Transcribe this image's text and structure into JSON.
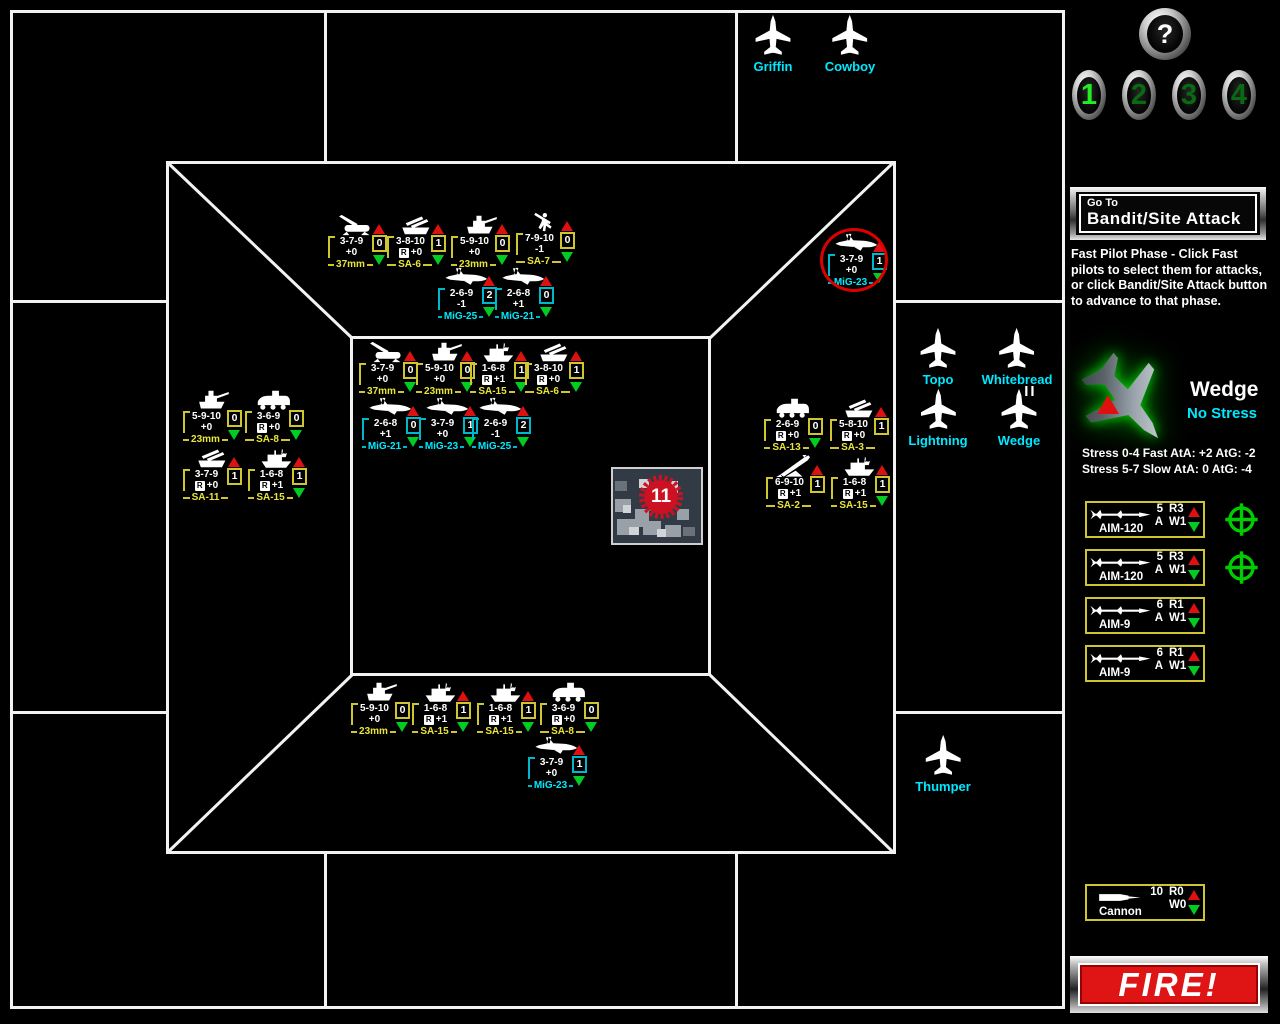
{
  "board": {
    "target": {
      "label": "11"
    },
    "counters": [
      {
        "type": "37mm",
        "icon": "aaa-gun-icon",
        "stats": "3-7-9",
        "mod": "+0",
        "radar": false,
        "value": "0",
        "up": true,
        "down": true,
        "color": "yellow",
        "circled": false,
        "x": 328,
        "y": 214
      },
      {
        "type": "SA-6",
        "icon": "samtrack-icon",
        "stats": "3-8-10",
        "mod": "+0",
        "radar": true,
        "value": "1",
        "up": true,
        "down": true,
        "color": "yellow",
        "circled": false,
        "x": 387,
        "y": 214
      },
      {
        "type": "23mm",
        "icon": "spaag-icon",
        "stats": "5-9-10",
        "mod": "+0",
        "radar": false,
        "value": "0",
        "up": true,
        "down": true,
        "color": "yellow",
        "circled": false,
        "x": 451,
        "y": 214
      },
      {
        "type": "SA-7",
        "icon": "manpad-icon",
        "stats": "7-9-10",
        "mod": "-1",
        "radar": false,
        "value": "0",
        "up": true,
        "down": true,
        "color": "yellow",
        "circled": false,
        "x": 516,
        "y": 211
      },
      {
        "type": "MiG-25",
        "icon": "mig-icon",
        "stats": "2-6-9",
        "mod": "-1",
        "radar": false,
        "value": "2",
        "up": true,
        "down": true,
        "color": "cyan",
        "circled": false,
        "x": 438,
        "y": 266
      },
      {
        "type": "MiG-21",
        "icon": "mig-icon",
        "stats": "2-6-8",
        "mod": "+1",
        "radar": false,
        "value": "0",
        "up": true,
        "down": true,
        "color": "cyan",
        "circled": false,
        "x": 495,
        "y": 266
      },
      {
        "type": "MiG-23",
        "icon": "mig-icon",
        "stats": "3-7-9",
        "mod": "+0",
        "radar": false,
        "value": "1",
        "up": true,
        "down": true,
        "color": "cyan",
        "circled": true,
        "x": 828,
        "y": 232
      },
      {
        "type": "37mm",
        "icon": "aaa-gun-icon",
        "stats": "3-7-9",
        "mod": "+0",
        "radar": false,
        "value": "0",
        "up": true,
        "down": true,
        "color": "yellow",
        "circled": false,
        "x": 359,
        "y": 341
      },
      {
        "type": "23mm",
        "icon": "spaag-icon",
        "stats": "5-9-10",
        "mod": "+0",
        "radar": false,
        "value": "0",
        "up": true,
        "down": true,
        "color": "yellow",
        "circled": false,
        "x": 416,
        "y": 341
      },
      {
        "type": "SA-15",
        "icon": "launcher-icon",
        "stats": "1-6-8",
        "mod": "+1",
        "radar": true,
        "value": "1",
        "up": true,
        "down": true,
        "color": "yellow",
        "circled": false,
        "x": 470,
        "y": 341
      },
      {
        "type": "SA-6",
        "icon": "samtrack-icon",
        "stats": "3-8-10",
        "mod": "+0",
        "radar": true,
        "value": "1",
        "up": true,
        "down": true,
        "color": "yellow",
        "circled": false,
        "x": 525,
        "y": 341
      },
      {
        "type": "MiG-21",
        "icon": "mig-icon",
        "stats": "2-6-8",
        "mod": "+1",
        "radar": false,
        "value": "0",
        "up": true,
        "down": true,
        "color": "cyan",
        "circled": false,
        "x": 362,
        "y": 396
      },
      {
        "type": "MiG-23",
        "icon": "mig-icon",
        "stats": "3-7-9",
        "mod": "+0",
        "radar": false,
        "value": "1",
        "up": true,
        "down": true,
        "color": "cyan",
        "circled": false,
        "x": 419,
        "y": 396
      },
      {
        "type": "MiG-25",
        "icon": "mig-icon",
        "stats": "2-6-9",
        "mod": "-1",
        "radar": false,
        "value": "2",
        "up": true,
        "down": true,
        "color": "cyan",
        "circled": false,
        "x": 472,
        "y": 396
      },
      {
        "type": "23mm",
        "icon": "spaag-icon",
        "stats": "5-9-10",
        "mod": "+0",
        "radar": false,
        "value": "0",
        "up": false,
        "down": true,
        "color": "yellow",
        "circled": false,
        "x": 183,
        "y": 389
      },
      {
        "type": "SA-8",
        "icon": "wheeled-icon",
        "stats": "3-6-9",
        "mod": "+0",
        "radar": true,
        "value": "0",
        "up": false,
        "down": true,
        "color": "yellow",
        "circled": false,
        "x": 245,
        "y": 389
      },
      {
        "type": "SA-11",
        "icon": "samtrack-icon",
        "stats": "3-7-9",
        "mod": "+0",
        "radar": true,
        "value": "1",
        "up": true,
        "down": false,
        "color": "yellow",
        "circled": false,
        "x": 183,
        "y": 447
      },
      {
        "type": "SA-15",
        "icon": "launcher-icon",
        "stats": "1-6-8",
        "mod": "+1",
        "radar": true,
        "value": "1",
        "up": true,
        "down": true,
        "color": "yellow",
        "circled": false,
        "x": 248,
        "y": 447
      },
      {
        "type": "SA-13",
        "icon": "wheeled-icon",
        "stats": "2-6-9",
        "mod": "+0",
        "radar": true,
        "value": "0",
        "up": false,
        "down": true,
        "color": "yellow",
        "circled": false,
        "x": 764,
        "y": 397
      },
      {
        "type": "SA-3",
        "icon": "samtrack-icon",
        "stats": "5-8-10",
        "mod": "+0",
        "radar": true,
        "value": "1",
        "up": true,
        "down": false,
        "color": "yellow",
        "circled": false,
        "x": 830,
        "y": 397
      },
      {
        "type": "SA-2",
        "icon": "sa2-icon",
        "stats": "6-9-10",
        "mod": "+1",
        "radar": true,
        "value": "1",
        "up": true,
        "down": false,
        "color": "yellow",
        "circled": false,
        "x": 766,
        "y": 455
      },
      {
        "type": "SA-15",
        "icon": "launcher-icon",
        "stats": "1-6-8",
        "mod": "+1",
        "radar": true,
        "value": "1",
        "up": true,
        "down": true,
        "color": "yellow",
        "circled": false,
        "x": 831,
        "y": 455
      },
      {
        "type": "23mm",
        "icon": "spaag-icon",
        "stats": "5-9-10",
        "mod": "+0",
        "radar": false,
        "value": "0",
        "up": false,
        "down": true,
        "color": "yellow",
        "circled": false,
        "x": 351,
        "y": 681
      },
      {
        "type": "SA-15",
        "icon": "launcher-icon",
        "stats": "1-6-8",
        "mod": "+1",
        "radar": true,
        "value": "1",
        "up": true,
        "down": true,
        "color": "yellow",
        "circled": false,
        "x": 412,
        "y": 681
      },
      {
        "type": "SA-15",
        "icon": "launcher-icon",
        "stats": "1-6-8",
        "mod": "+1",
        "radar": true,
        "value": "1",
        "up": true,
        "down": true,
        "color": "yellow",
        "circled": false,
        "x": 477,
        "y": 681
      },
      {
        "type": "SA-8",
        "icon": "wheeled-icon",
        "stats": "3-6-9",
        "mod": "+0",
        "radar": true,
        "value": "0",
        "up": false,
        "down": true,
        "color": "yellow",
        "circled": false,
        "x": 540,
        "y": 681
      },
      {
        "type": "MiG-23",
        "icon": "mig-icon",
        "stats": "3-7-9",
        "mod": "+0",
        "radar": false,
        "value": "1",
        "up": true,
        "down": true,
        "color": "cyan",
        "circled": false,
        "x": 528,
        "y": 735
      }
    ],
    "pilots": [
      {
        "name": "Griffin",
        "x": 773,
        "y": 13
      },
      {
        "name": "Cowboy",
        "x": 850,
        "y": 13
      },
      {
        "name": "Topo",
        "x": 938,
        "y": 326
      },
      {
        "name": "Whitebread",
        "x": 1017,
        "y": 326
      },
      {
        "name": "Lightning",
        "x": 938,
        "y": 387
      },
      {
        "name": "Wedge",
        "marker": "II",
        "x": 1019,
        "y": 387
      },
      {
        "name": "Thumper",
        "x": 943,
        "y": 733
      }
    ]
  },
  "sidebar": {
    "help_button": {
      "label": "?"
    },
    "pilot_buttons": [
      {
        "label": "1",
        "active": true,
        "x": 1072,
        "y": 70
      },
      {
        "label": "2",
        "active": false,
        "x": 1122,
        "y": 70
      },
      {
        "label": "3",
        "active": false,
        "x": 1172,
        "y": 70
      },
      {
        "label": "4",
        "active": false,
        "x": 1222,
        "y": 70
      }
    ],
    "goto_button": {
      "line1": "Go To",
      "line2": "Bandit/Site Attack"
    },
    "instructions": "Fast Pilot Phase - Click Fast pilots to select them for attacks, or click Bandit/Site Attack button to advance to that phase.",
    "selected_pilot": {
      "name": "Wedge",
      "status": "No Stress",
      "stress_fast": "Stress 0-4 Fast AtA: +2 AtG: -2",
      "stress_slow": "Stress 5-7 Slow AtA: 0 AtG: -4"
    },
    "weapons": [
      {
        "name": "AIM-120",
        "qty": "5",
        "range": "R3",
        "mode": "A",
        "weight": "W1",
        "icon": "missile-icon",
        "crosshair": true,
        "x": 1085,
        "y": 501
      },
      {
        "name": "AIM-120",
        "qty": "5",
        "range": "R3",
        "mode": "A",
        "weight": "W1",
        "icon": "missile-icon",
        "crosshair": true,
        "x": 1085,
        "y": 549
      },
      {
        "name": "AIM-9",
        "qty": "6",
        "range": "R1",
        "mode": "A",
        "weight": "W1",
        "icon": "missile-icon",
        "crosshair": false,
        "x": 1085,
        "y": 597
      },
      {
        "name": "AIM-9",
        "qty": "6",
        "range": "R1",
        "mode": "A",
        "weight": "W1",
        "icon": "missile-icon",
        "crosshair": false,
        "x": 1085,
        "y": 645
      },
      {
        "name": "Cannon",
        "qty": "10",
        "range": "R0",
        "mode": "",
        "weight": "W0",
        "icon": "bullet-icon",
        "crosshair": false,
        "x": 1085,
        "y": 884
      }
    ],
    "fire_button": {
      "label": "FIRE!"
    }
  },
  "colors": {
    "yellow_frame": "#cfc52e",
    "yellow_label": "#e8e43a",
    "cyan_frame": "#00b8cc",
    "cyan_label": "#00eaff",
    "pilot_name": "#00e8ff",
    "alert_red": "#dd1111",
    "ok_green": "#00cc22",
    "fire_red": "#df1414"
  }
}
